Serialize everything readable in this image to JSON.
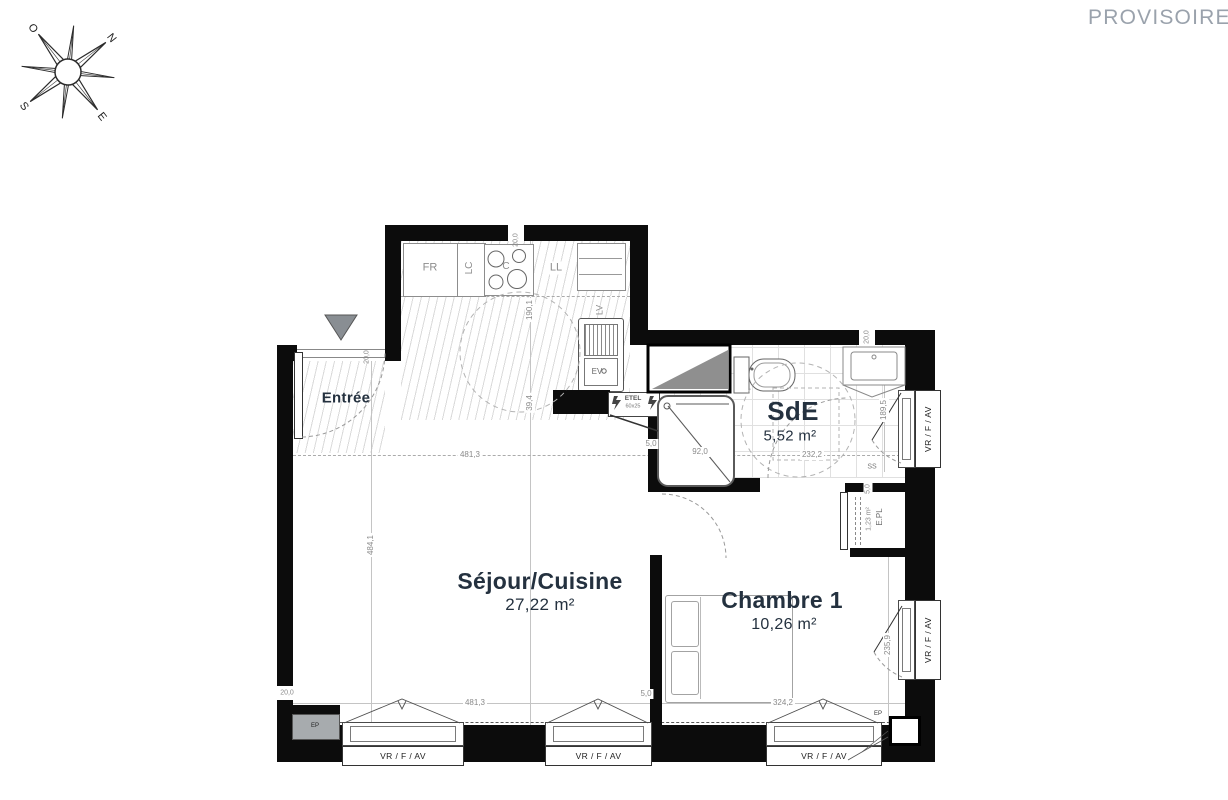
{
  "watermark": "PROVISOIRE",
  "compass": {
    "north": "N",
    "south": "S",
    "east": "E",
    "west": "O"
  },
  "rooms": {
    "entree": {
      "name": "Entrée"
    },
    "sejour": {
      "name": "Séjour/Cuisine",
      "area": "27,22 m²"
    },
    "sde": {
      "name": "SdE",
      "area": "5,52 m²"
    },
    "chambre": {
      "name": "Chambre 1",
      "area": "10,26 m²"
    },
    "placard": {
      "name": "E.PL",
      "area": "1,23 m²"
    }
  },
  "fixtures": {
    "fridge": "FR",
    "tall_unit": "LC",
    "cooktop": "C",
    "washer": "LL",
    "dishwasher": "LV",
    "sink": "EV",
    "elec_panel": "ETEL",
    "elec_panel_size": "60x25",
    "towel_rail": "SS",
    "ep": "EP"
  },
  "window_label": "VR / F / AV",
  "dims": {
    "sejour_width_mid": "481,3",
    "sejour_width_bottom": "481,3",
    "sejour_height": "484,1",
    "kitchen_depth": "190,1",
    "kitchen_lower": "39,4",
    "sde_width": "232,2",
    "sde_height": "189,5",
    "sde_wall_top": "20,0",
    "shower_width": "92,0",
    "chambre_width": "324,2",
    "chambre_height": "235,9",
    "wall_kitchen_top": "20,0",
    "wall_entree": "20,0",
    "wall_bottom_left": "20,0",
    "gap_sde_door": "5,0",
    "gap_epl": "5,0",
    "gap_chambre": "5,0"
  }
}
